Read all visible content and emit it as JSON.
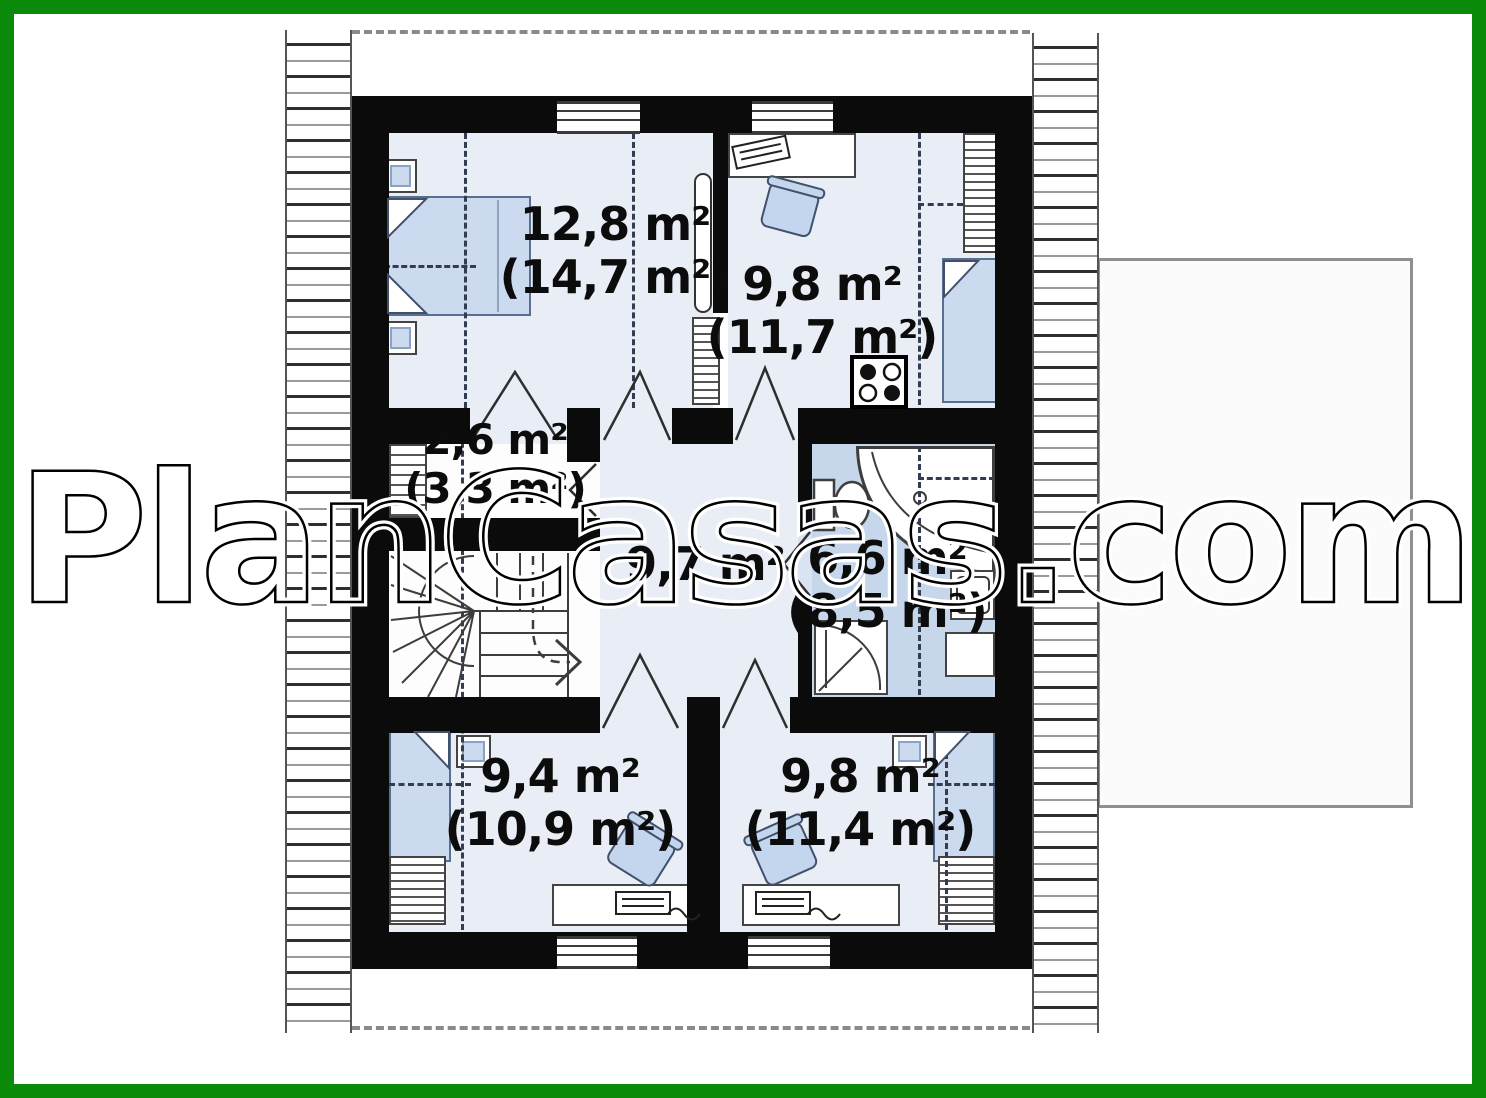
{
  "watermark": {
    "text": "PlanCasas.com"
  },
  "colors": {
    "frame_green": "#0b8a0b",
    "wall_black": "#0b0b0b",
    "room_fill": "#e9eef6",
    "bathroom_fill": "#c7d7eb",
    "furniture_fill": "#cbdaef",
    "furniture_stroke": "#56708e"
  },
  "rooms": [
    {
      "id": "bedroom-top-left",
      "area": "12,8 m²",
      "area_gross": "(14,7 m²)"
    },
    {
      "id": "room-top-right",
      "area": "9,8 m²",
      "area_gross": "(11,7 m²)"
    },
    {
      "id": "closet",
      "area": "2,6 m²",
      "area_gross": "(3,3 m²)"
    },
    {
      "id": "hall",
      "area": "9,7 m²",
      "area_gross": ""
    },
    {
      "id": "bathroom",
      "area": "6,6 m²",
      "area_gross": "(8,5 m²)"
    },
    {
      "id": "room-bottom-left",
      "area": "9,4 m²",
      "area_gross": "(10,9 m²)"
    },
    {
      "id": "room-bottom-right",
      "area": "9,8 m²",
      "area_gross": "(11,4 m²)"
    }
  ],
  "fixtures": [
    "double-bed",
    "single-bed",
    "nightstand",
    "wardrobe",
    "desk",
    "office-chair",
    "winder-staircase",
    "corner-bathtub",
    "toilet",
    "shower",
    "washbasin",
    "cooktop"
  ]
}
